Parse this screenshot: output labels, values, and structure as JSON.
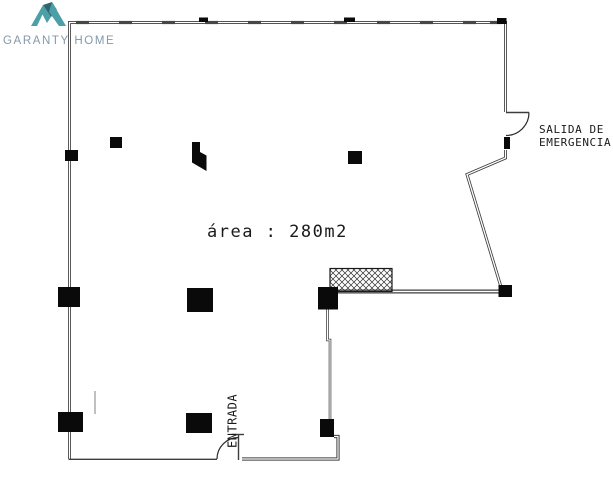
{
  "brand": {
    "name": "GARANTY HOME",
    "colors": {
      "teal": "#4aa0a6",
      "teal_dark": "#2f6570",
      "text": "#8598a9"
    }
  },
  "floorplan": {
    "area_label": "área : 280m2",
    "entrance_label": "ENTRADA",
    "emergency_exit": {
      "line1": "SALIDA DE",
      "line2": "EMERGENCIA"
    },
    "colors": {
      "walls": "#3d3d3d",
      "columns": "#0a0a0a",
      "text": "#1a1a1a"
    }
  }
}
